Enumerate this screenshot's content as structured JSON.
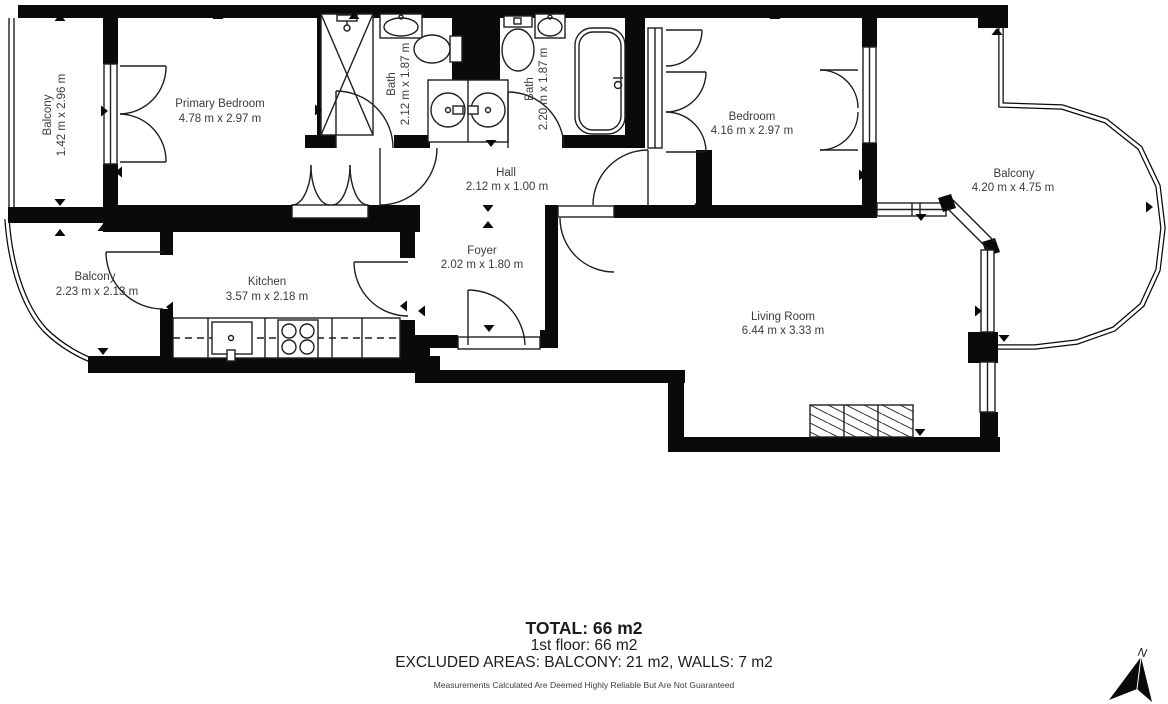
{
  "plan": {
    "rooms": [
      {
        "id": "balcony-left",
        "name": "Balcony",
        "dims": "1.42 m x 2.96 m"
      },
      {
        "id": "primary-bedroom",
        "name": "Primary Bedroom",
        "dims": "4.78 m x 2.97 m"
      },
      {
        "id": "bath-1",
        "name": "Bath",
        "dims": "2.12 m x 1.87 m"
      },
      {
        "id": "bath-2",
        "name": "Bath",
        "dims": "2.20 m x 1.87 m"
      },
      {
        "id": "bedroom",
        "name": "Bedroom",
        "dims": "4.16 m x 2.97 m"
      },
      {
        "id": "balcony-right",
        "name": "Balcony",
        "dims": "4.20 m x 4.75 m"
      },
      {
        "id": "balcony-lower",
        "name": "Balcony",
        "dims": "2.23 m x 2.13 m"
      },
      {
        "id": "kitchen",
        "name": "Kitchen",
        "dims": "3.57 m x 2.18 m"
      },
      {
        "id": "hall",
        "name": "Hall",
        "dims": "2.12 m x 1.00 m"
      },
      {
        "id": "foyer",
        "name": "Foyer",
        "dims": "2.02 m x 1.80 m"
      },
      {
        "id": "living-room",
        "name": "Living Room",
        "dims": "6.44 m x 3.33 m"
      }
    ],
    "summary": {
      "total": "TOTAL: 66 m2",
      "floor": "1st floor: 66 m2",
      "excluded": "EXCLUDED AREAS: BALCONY: 21 m2, WALLS: 7 m2",
      "disclaimer": "Measurements Calculated Are Deemed Highly Reliable But Are Not Guaranteed"
    },
    "compass": {
      "label": "N"
    },
    "colors": {
      "wall": "#0a0a0a",
      "line": "#1f1f1f",
      "text": "#3b3b3b"
    }
  }
}
